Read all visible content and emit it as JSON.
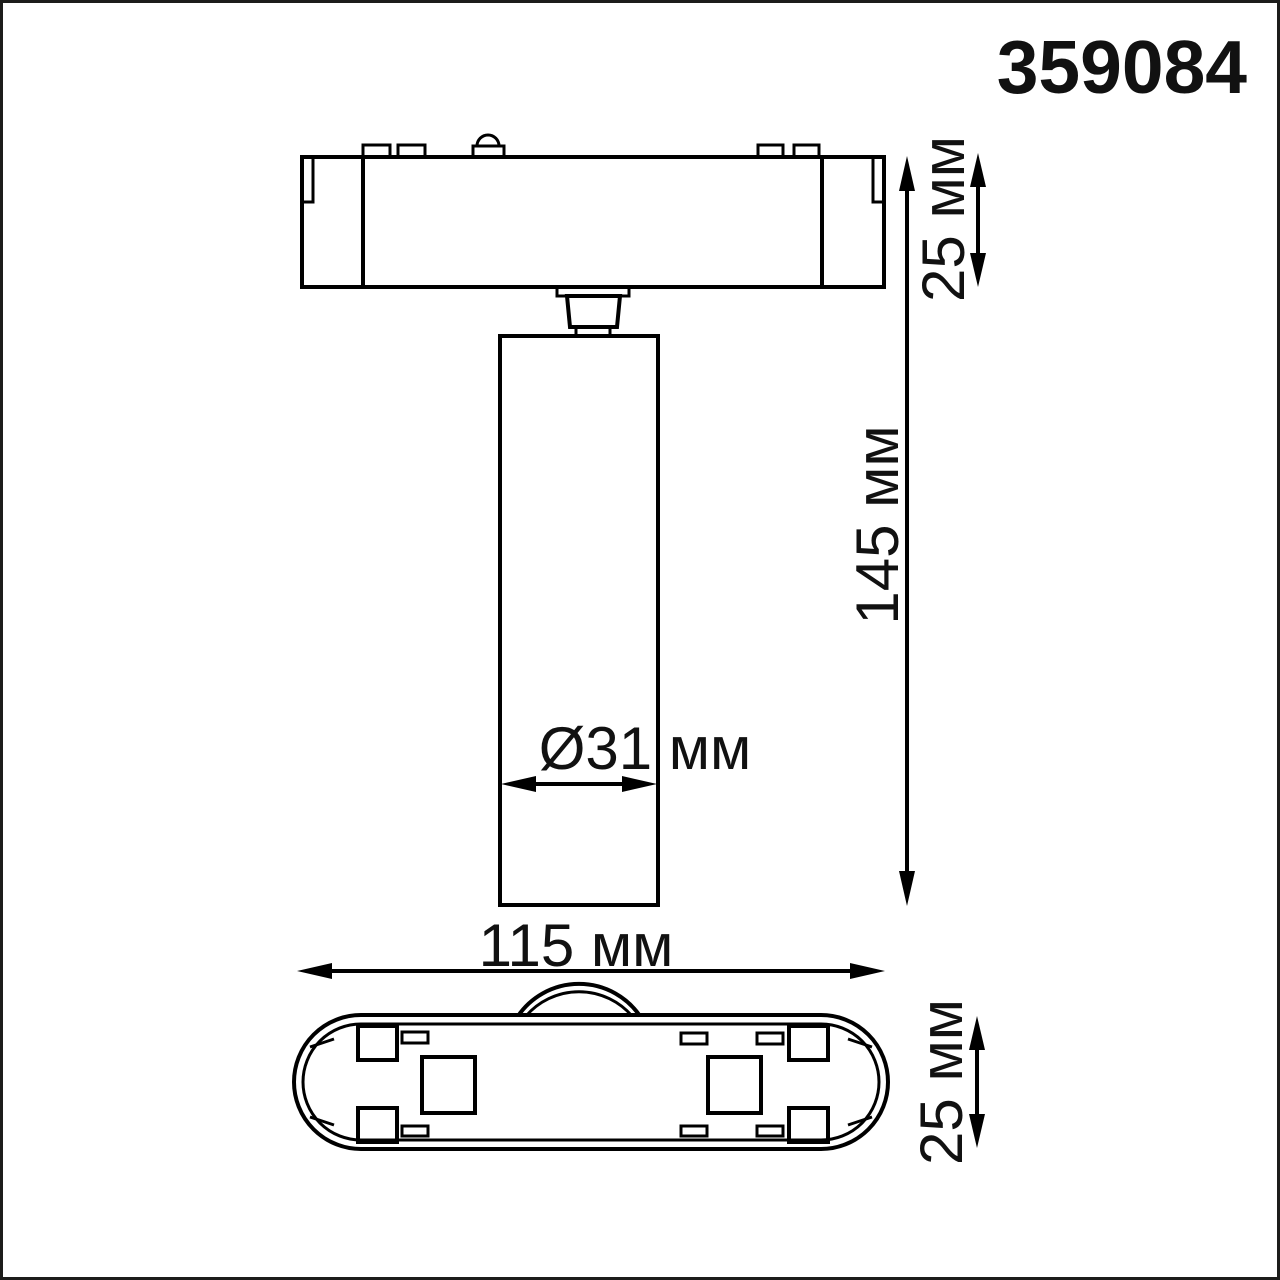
{
  "product_code": "359084",
  "dimensions": {
    "adapter_height": {
      "text": "25 мм",
      "value": 25,
      "unit": "мм"
    },
    "overall_height": {
      "text": "145 мм",
      "value": 145,
      "unit": "мм"
    },
    "spot_diameter": {
      "text": "Ø31 мм",
      "value": 31,
      "unit": "мм"
    },
    "overall_width": {
      "text": "115 мм",
      "value": 115,
      "unit": "мм"
    },
    "base_height": {
      "text": "25 мм",
      "value": 25,
      "unit": "мм"
    }
  },
  "colors": {
    "line": "#000000",
    "text": "#111111",
    "background": "#ffffff",
    "frame": "#1d1d1b"
  }
}
